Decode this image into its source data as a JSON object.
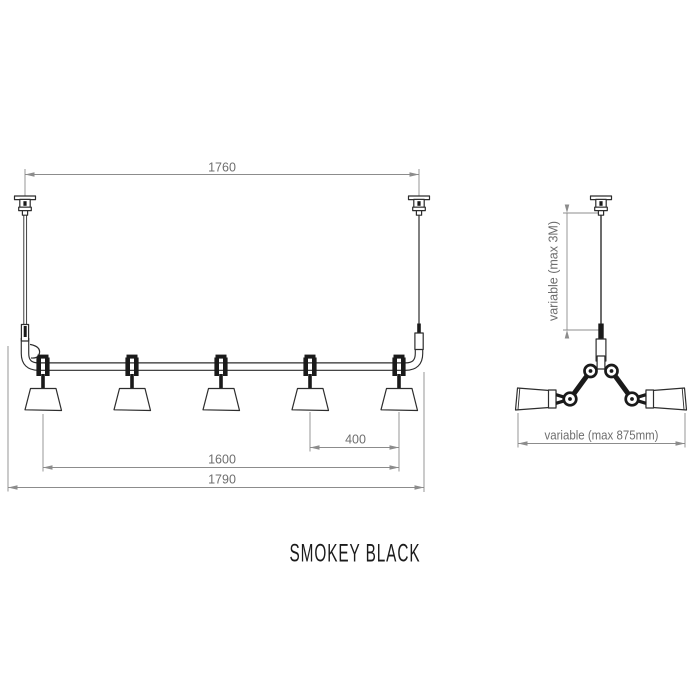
{
  "drawing": {
    "product_name": "SMOKEY BLACK",
    "front_view": {
      "lamp_count": 5,
      "dims": {
        "suspension_span": "1760",
        "lamp_spacing": "400",
        "lamp_span": "1600",
        "overall_width": "1790"
      }
    },
    "side_view": {
      "dims": {
        "drop_height": "variable (max 3M)",
        "head_spread": "variable (max 875mm)"
      }
    },
    "colors": {
      "background": "#ffffff",
      "product_line": "#2d2d2d",
      "solid_black": "#1a1a1a",
      "dimension_line": "#8c8c8c",
      "dimension_text": "#6e6e6e",
      "title_text": "#1b1b1b"
    }
  }
}
